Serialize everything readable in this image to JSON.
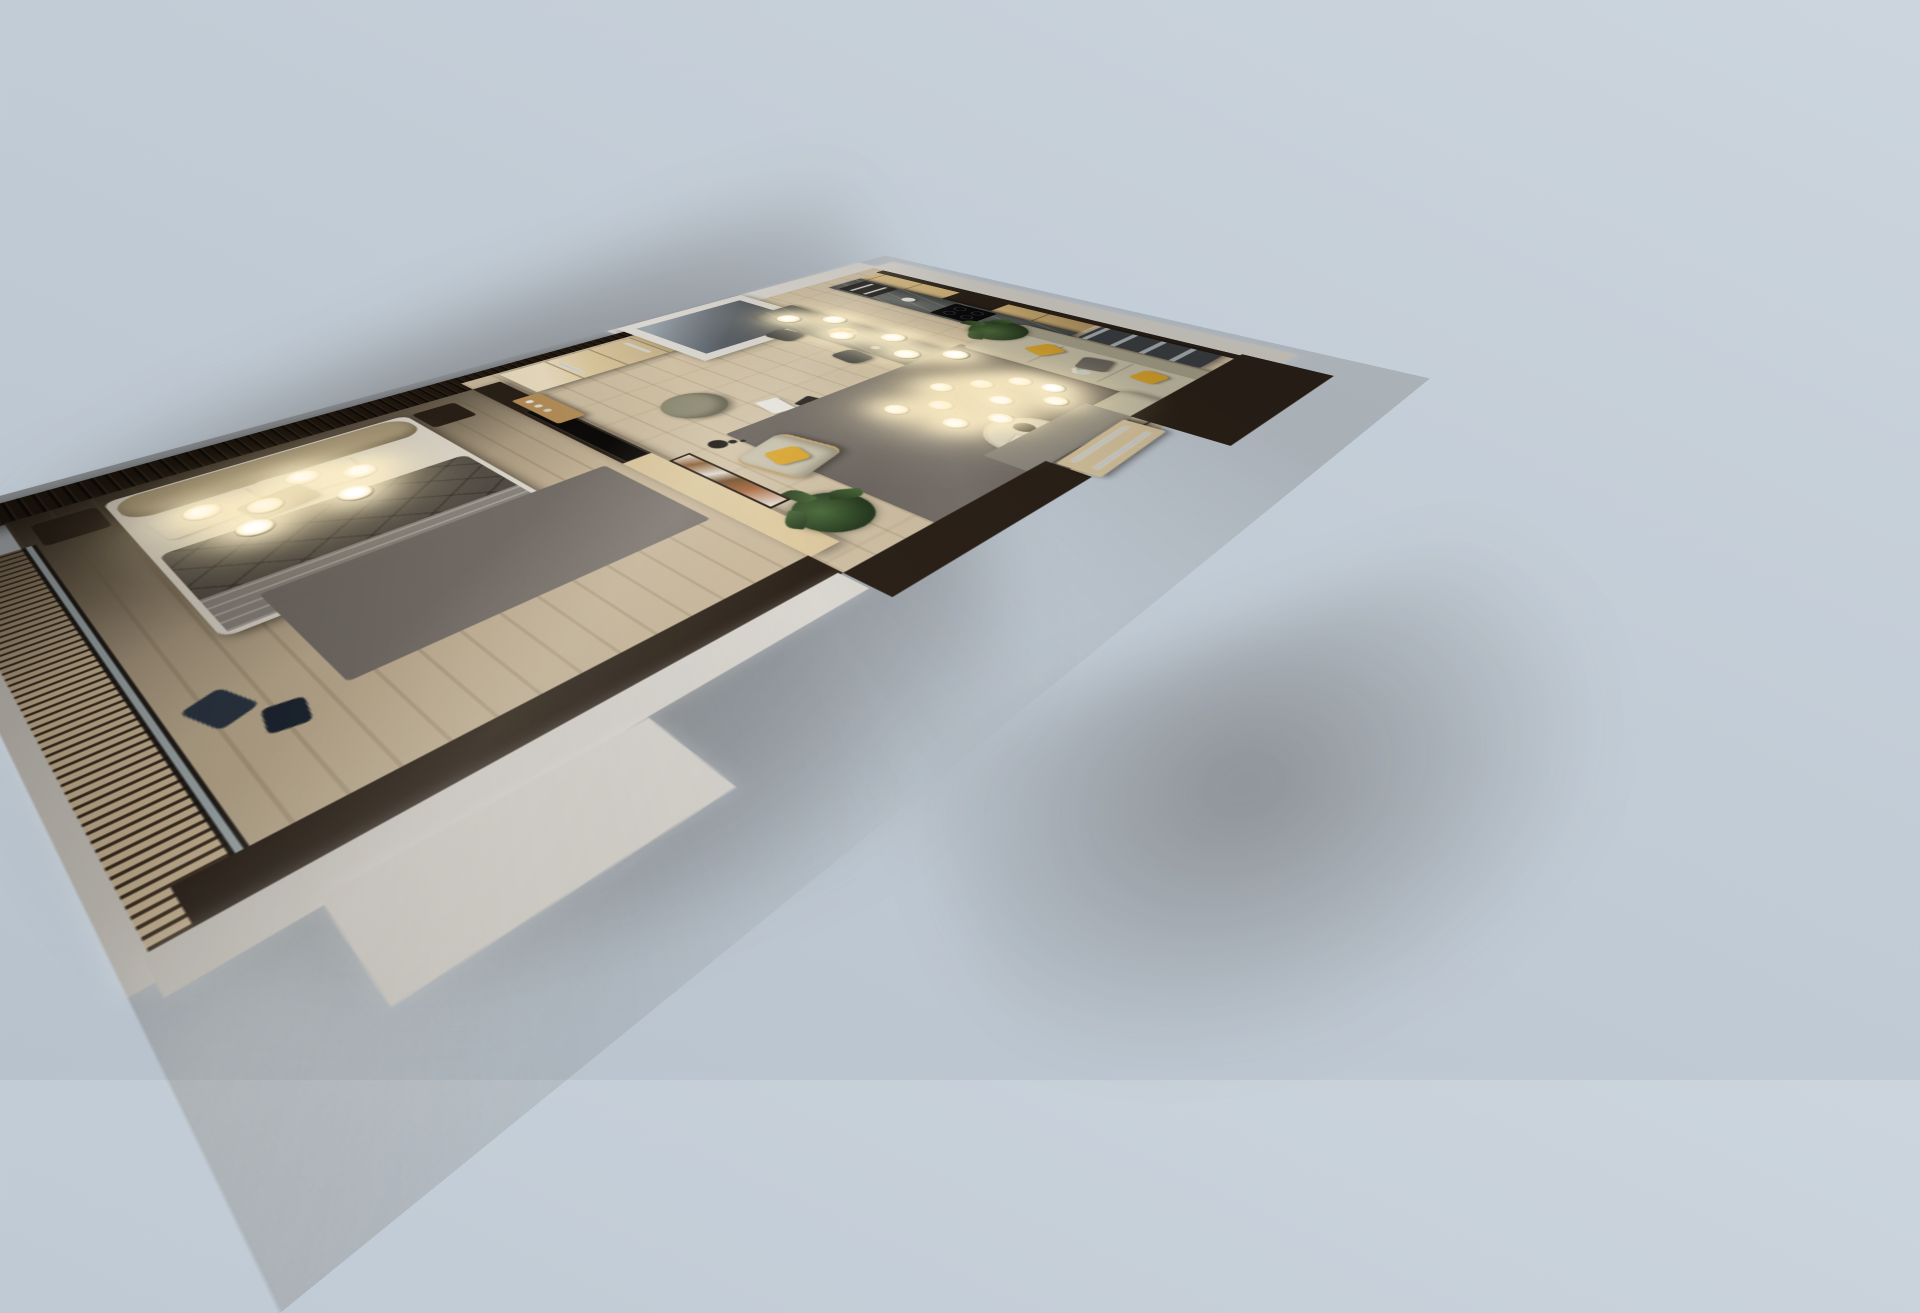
{
  "scene": {
    "description": "Photorealistic 3D dollhouse render of a one-bedroom apartment, bird's-eye oblique view, no visible text or UI controls",
    "view": "top-down cutaway with tall dark wood walls, warm artificial lighting, soft shadow cast to lower left",
    "background_color": "#c2ccd6"
  },
  "palette": {
    "bg": "#c2ccd6",
    "bg_light": "#ccd5dd",
    "bg_dark": "#b7c2cc",
    "wall": "#2b2118",
    "wall_dark": "#211810",
    "exterior": "#dad7d1",
    "floor": "#cfc0a4",
    "floor_bedroom": "#c9b89b",
    "slat": "#d6c3a1",
    "slat_gap": "#3f2f21",
    "glass": "#a7b5bb",
    "marble": "#3e4140",
    "cabinet": "#d7b87c",
    "wardrobe": "#ddc99f",
    "rug": "#7a736d",
    "sofa": "#c7c1ab",
    "accent_yellow": "#d9a42c",
    "pillow_gray": "#6a655f",
    "linen": "#e9e4d9",
    "duvet": "#565049",
    "throw": "#918b84",
    "headboard": "#b2a280",
    "glow": "#fff3d2",
    "steel": "#ccd1d5",
    "chair_wood": "#c2a06b",
    "stool": "#2b2e32",
    "plant": "#27391f",
    "plant_light": "#4a6b3a",
    "pouf": "#8e8b74",
    "art_rust": "#a4633a",
    "appliance_black": "#14110e",
    "tv_black": "#0d0b09",
    "orange_fruit": "#e08b2c",
    "door": "#d8c6a1",
    "entry_tile": "#8f8a82"
  },
  "rooms": [
    {
      "name": "balcony",
      "features": [
        "slatted wood decking",
        "white parapet wall"
      ]
    },
    {
      "name": "bedroom",
      "features": [
        "double bed with olive leather headboard",
        "white linen pillows",
        "dark gray quilted duvet",
        "gray throw",
        "two dark nightstands",
        "six glowing pendant lamps",
        "gray rug",
        "wall-mounted TV panel",
        "dark ribbed accent wall",
        "window to balcony",
        "blue clothes on floor"
      ]
    },
    {
      "name": "entry-hall",
      "features": [
        "light oak wardrobe with steel pull handles",
        "wood console with perfume bottles",
        "round green pouf",
        "white shopping bag",
        "black shopping bag",
        "potted plant"
      ]
    },
    {
      "name": "bathroom",
      "features": [
        "white-walled enclosure seen from above, interior in shadow"
      ]
    },
    {
      "name": "kitchen",
      "features": [
        "oak cabinet fronts",
        "dark marble counter and backsplash",
        "built-in oven and microwave stack",
        "black induction cooktop",
        "kettle",
        "dark marble island",
        "fruit bowl with oranges",
        "two dark bar chairs",
        "six pendant globe lights"
      ]
    },
    {
      "name": "dining",
      "features": [
        "light oak table",
        "three yellow upholstered chairs",
        "wood serving tray with white tea set",
        "dark plate"
      ]
    },
    {
      "name": "living-room",
      "features": [
        "sage L-shaped sofa",
        "yellow and gray cushions",
        "ten-bulb modern chandelier",
        "round white coffee table with black tray",
        "round dark side table with white plate",
        "fabric armchair with yellow cushion",
        "black floor lamp",
        "large gray rug",
        "abstract rust artwork on light wood partition",
        "fiddle-leaf fig plant",
        "flower vase",
        "gray media cabinet",
        "entry door with steel handle"
      ]
    }
  ],
  "lighting": {
    "bedroom_pendant_bulbs": 6,
    "island_pendant_bulbs": 6,
    "living_chandelier_bulbs": 10,
    "glow_color": "#fff3d2"
  }
}
